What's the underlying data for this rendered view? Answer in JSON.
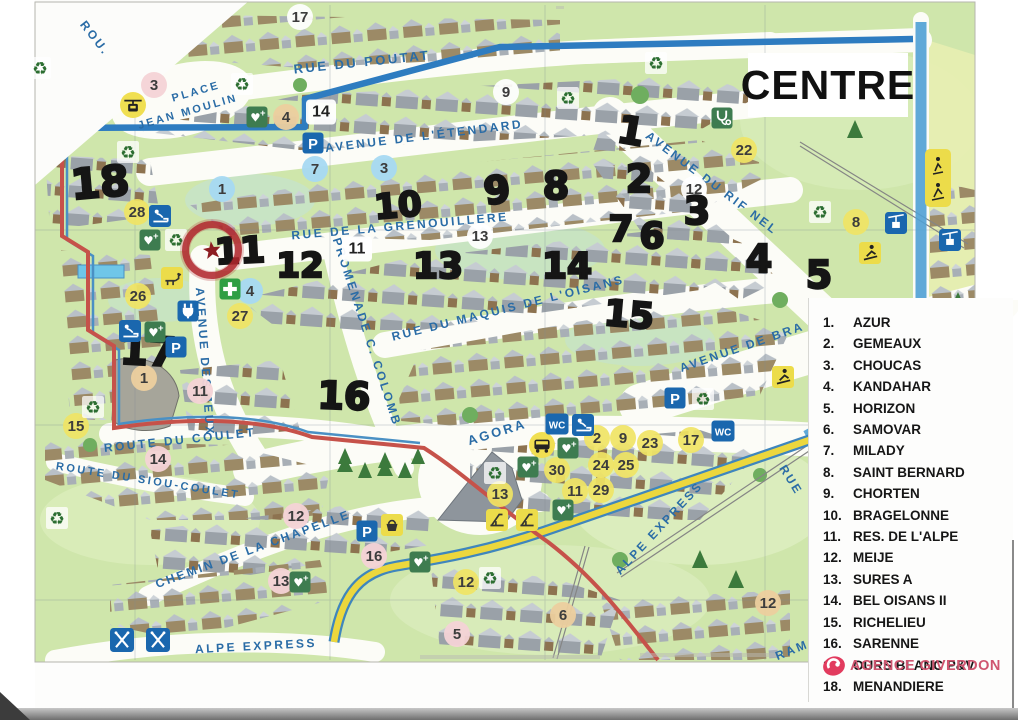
{
  "title": {
    "text": "CENTRE"
  },
  "agency": {
    "name": "AGENCE GIVERDON"
  },
  "colors": {
    "accent_blue": "#1a67ae",
    "route_blue": "#2e7cc0",
    "route_red": "#c6524a",
    "route_yellow": "#ecd73d",
    "street_label": "#2a6ca6",
    "legend_text": "#161616",
    "agency_pink": "#cf5670",
    "badge_yellow": "#f0e464",
    "badge_pink": "#f4d3d6",
    "badge_blue": "#a6d9f2",
    "badge_tan": "#eccf9e",
    "map_green": "#cfe6ab"
  },
  "legend": {
    "items": [
      {
        "num": "1.",
        "label": "AZUR"
      },
      {
        "num": "2.",
        "label": "GEMEAUX"
      },
      {
        "num": "3.",
        "label": "CHOUCAS"
      },
      {
        "num": "4.",
        "label": "KANDAHAR"
      },
      {
        "num": "5.",
        "label": "HORIZON"
      },
      {
        "num": "6.",
        "label": "SAMOVAR"
      },
      {
        "num": "7.",
        "label": "MILADY"
      },
      {
        "num": "8.",
        "label": "SAINT BERNARD"
      },
      {
        "num": "9.",
        "label": "CHORTEN"
      },
      {
        "num": "10.",
        "label": "BRAGELONNE"
      },
      {
        "num": "11.",
        "label": "RES. DE L'ALPE"
      },
      {
        "num": "12.",
        "label": "MEIJE"
      },
      {
        "num": "13.",
        "label": "SURES A"
      },
      {
        "num": "14.",
        "label": "BEL OISANS II"
      },
      {
        "num": "15.",
        "label": "RICHELIEU"
      },
      {
        "num": "16.",
        "label": "SARENNE"
      },
      {
        "num": "17.",
        "label": "OURS BLANC P&V"
      },
      {
        "num": "18.",
        "label": "MENANDIERE"
      }
    ]
  },
  "streets": [
    {
      "name": "ROU.",
      "x": 95,
      "y": 38,
      "rot": 52,
      "size": 12
    },
    {
      "name": "RUE DU POUTAT",
      "x": 362,
      "y": 62,
      "rot": -6,
      "size": 13
    },
    {
      "name": "PLACE",
      "x": 196,
      "y": 92,
      "rot": -16,
      "size": 11
    },
    {
      "name": "JEAN MOULIN",
      "x": 188,
      "y": 112,
      "rot": -16,
      "size": 11
    },
    {
      "name": "AVENUE DE L'ÉTENDARD",
      "x": 424,
      "y": 136,
      "rot": -7,
      "size": 12
    },
    {
      "name": "RUE DE LA GRENOUILLERE",
      "x": 400,
      "y": 226,
      "rot": -5,
      "size": 12
    },
    {
      "name": "AVENUE DU RIF NEL",
      "x": 712,
      "y": 183,
      "rot": 37,
      "size": 12
    },
    {
      "name": "RUE DU MAQUIS DE L'OISANS",
      "x": 508,
      "y": 308,
      "rot": -14,
      "size": 12
    },
    {
      "name": "AVENUE DE BRA",
      "x": 742,
      "y": 347,
      "rot": -19,
      "size": 12
    },
    {
      "name": "AVENUE DES JEUX",
      "x": 205,
      "y": 362,
      "rot": 86,
      "size": 12
    },
    {
      "name": "PROMENADE C. COLOMB",
      "x": 367,
      "y": 332,
      "rot": 72,
      "size": 12
    },
    {
      "name": "AGORA",
      "x": 497,
      "y": 432,
      "rot": -17,
      "size": 13
    },
    {
      "name": "ROUTE DU COULET",
      "x": 180,
      "y": 440,
      "rot": -6,
      "size": 12
    },
    {
      "name": "ROUTE DU SIOU-COULET",
      "x": 148,
      "y": 481,
      "rot": 9,
      "size": 11
    },
    {
      "name": "CHEMIN DE LA CHAPELLE",
      "x": 253,
      "y": 549,
      "rot": -20,
      "size": 12
    },
    {
      "name": "ALPE EXPRESS",
      "x": 256,
      "y": 646,
      "rot": -3,
      "size": 12
    },
    {
      "name": "ALPE EXPRESS",
      "x": 659,
      "y": 528,
      "rot": -47,
      "size": 12
    },
    {
      "name": "RUE",
      "x": 791,
      "y": 480,
      "rot": 58,
      "size": 12
    },
    {
      "name": "RAM",
      "x": 792,
      "y": 650,
      "rot": -22,
      "size": 12
    }
  ],
  "markers": [
    {
      "n": "18",
      "x": 100,
      "y": 183,
      "rot": -5,
      "size": 42
    },
    {
      "n": "17",
      "x": 148,
      "y": 352,
      "rot": 3,
      "size": 40
    },
    {
      "n": "11",
      "x": 240,
      "y": 252,
      "rot": -3,
      "size": 36
    },
    {
      "n": "12",
      "x": 300,
      "y": 266,
      "rot": 0,
      "size": 34
    },
    {
      "n": "16",
      "x": 344,
      "y": 396,
      "rot": 2,
      "size": 38
    },
    {
      "n": "10",
      "x": 398,
      "y": 206,
      "rot": -5,
      "size": 34
    },
    {
      "n": "13",
      "x": 438,
      "y": 267,
      "rot": 0,
      "size": 36
    },
    {
      "n": "9",
      "x": 497,
      "y": 190,
      "rot": -8,
      "size": 38
    },
    {
      "n": "8",
      "x": 556,
      "y": 186,
      "rot": 0,
      "size": 38
    },
    {
      "n": "14",
      "x": 567,
      "y": 267,
      "rot": 0,
      "size": 36
    },
    {
      "n": "15",
      "x": 629,
      "y": 316,
      "rot": 5,
      "size": 36
    },
    {
      "n": "7",
      "x": 621,
      "y": 230,
      "rot": 0,
      "size": 36
    },
    {
      "n": "6",
      "x": 652,
      "y": 237,
      "rot": 0,
      "size": 36
    },
    {
      "n": "1",
      "x": 631,
      "y": 131,
      "rot": 10,
      "size": 38
    },
    {
      "n": "2",
      "x": 639,
      "y": 179,
      "rot": 0,
      "size": 38
    },
    {
      "n": "3",
      "x": 697,
      "y": 211,
      "rot": 0,
      "size": 38
    },
    {
      "n": "4",
      "x": 759,
      "y": 259,
      "rot": 0,
      "size": 38
    },
    {
      "n": "5",
      "x": 819,
      "y": 275,
      "rot": 0,
      "size": 38
    }
  ],
  "badges": [
    {
      "n": "17",
      "color": "white",
      "x": 300,
      "y": 17
    },
    {
      "n": "3",
      "color": "pink",
      "x": 154,
      "y": 85
    },
    {
      "n": "4",
      "color": "tan",
      "x": 286,
      "y": 117
    },
    {
      "n": "14",
      "color": "box",
      "x": 321,
      "y": 112
    },
    {
      "n": "9",
      "color": "white",
      "x": 506,
      "y": 92
    },
    {
      "n": "22",
      "color": "yellow",
      "x": 744,
      "y": 150
    },
    {
      "n": "1",
      "color": "blue",
      "x": 222,
      "y": 189
    },
    {
      "n": "7",
      "color": "blue",
      "x": 315,
      "y": 169
    },
    {
      "n": "3",
      "color": "blue",
      "x": 384,
      "y": 168
    },
    {
      "n": "12",
      "color": "white",
      "x": 694,
      "y": 189
    },
    {
      "n": "13",
      "color": "white",
      "x": 480,
      "y": 236
    },
    {
      "n": "11",
      "color": "box",
      "x": 357,
      "y": 249
    },
    {
      "n": "8",
      "color": "yellow",
      "x": 856,
      "y": 222
    },
    {
      "n": "28",
      "color": "yellow",
      "x": 137,
      "y": 212
    },
    {
      "n": "26",
      "color": "yellow",
      "x": 138,
      "y": 296
    },
    {
      "n": "4",
      "color": "blue",
      "x": 250,
      "y": 291
    },
    {
      "n": "27",
      "color": "yellow",
      "x": 240,
      "y": 316
    },
    {
      "n": "1",
      "color": "tan",
      "x": 144,
      "y": 378
    },
    {
      "n": "11",
      "color": "pink",
      "x": 200,
      "y": 391
    },
    {
      "n": "15",
      "color": "yellow",
      "x": 76,
      "y": 426
    },
    {
      "n": "14",
      "color": "pink",
      "x": 158,
      "y": 459
    },
    {
      "n": "12",
      "color": "pink",
      "x": 296,
      "y": 516
    },
    {
      "n": "16",
      "color": "pink",
      "x": 374,
      "y": 556
    },
    {
      "n": "13",
      "color": "pink",
      "x": 281,
      "y": 581
    },
    {
      "n": "12",
      "color": "yellow",
      "x": 466,
      "y": 582
    },
    {
      "n": "5",
      "color": "pink",
      "x": 457,
      "y": 634
    },
    {
      "n": "6",
      "color": "tan",
      "x": 563,
      "y": 615
    },
    {
      "n": "12",
      "color": "tan",
      "x": 768,
      "y": 603
    },
    {
      "n": "2",
      "color": "yellow",
      "x": 597,
      "y": 438
    },
    {
      "n": "9",
      "color": "yellow",
      "x": 623,
      "y": 438
    },
    {
      "n": "23",
      "color": "yellow",
      "x": 650,
      "y": 443
    },
    {
      "n": "17",
      "color": "yellow",
      "x": 691,
      "y": 440
    },
    {
      "n": "24",
      "color": "yellow",
      "x": 601,
      "y": 465
    },
    {
      "n": "25",
      "color": "yellow",
      "x": 626,
      "y": 465
    },
    {
      "n": "30",
      "color": "yellow",
      "x": 557,
      "y": 470
    },
    {
      "n": "11",
      "color": "yellow",
      "x": 575,
      "y": 491
    },
    {
      "n": "29",
      "color": "yellow",
      "x": 601,
      "y": 490
    },
    {
      "n": "13",
      "color": "yellow",
      "x": 500,
      "y": 494
    }
  ],
  "icons": [
    {
      "type": "gondola-circle",
      "x": 133,
      "y": 105
    },
    {
      "type": "bus-circle",
      "x": 542,
      "y": 445
    },
    {
      "type": "parking",
      "x": 313,
      "y": 143
    },
    {
      "type": "parking",
      "x": 176,
      "y": 347
    },
    {
      "type": "parking",
      "x": 675,
      "y": 398
    },
    {
      "type": "parking",
      "x": 367,
      "y": 531
    },
    {
      "type": "wc",
      "x": 557,
      "y": 424
    },
    {
      "type": "wc",
      "x": 723,
      "y": 431
    },
    {
      "type": "baby",
      "x": 160,
      "y": 216
    },
    {
      "type": "baby",
      "x": 130,
      "y": 331
    },
    {
      "type": "baby",
      "x": 583,
      "y": 425
    },
    {
      "type": "defib",
      "x": 257,
      "y": 117
    },
    {
      "type": "defib",
      "x": 150,
      "y": 240
    },
    {
      "type": "defib",
      "x": 155,
      "y": 332
    },
    {
      "type": "defib",
      "x": 528,
      "y": 467
    },
    {
      "type": "defib",
      "x": 568,
      "y": 448
    },
    {
      "type": "defib",
      "x": 563,
      "y": 510
    },
    {
      "type": "defib",
      "x": 420,
      "y": 562
    },
    {
      "type": "defib",
      "x": 300,
      "y": 582
    },
    {
      "type": "recycle",
      "x": 128,
      "y": 152
    },
    {
      "type": "recycle",
      "x": 176,
      "y": 240
    },
    {
      "type": "recycle",
      "x": 242,
      "y": 84
    },
    {
      "type": "recycle",
      "x": 568,
      "y": 98
    },
    {
      "type": "recycle",
      "x": 656,
      "y": 63
    },
    {
      "type": "recycle",
      "x": 820,
      "y": 212
    },
    {
      "type": "recycle",
      "x": 703,
      "y": 399
    },
    {
      "type": "recycle",
      "x": 495,
      "y": 473
    },
    {
      "type": "recycle",
      "x": 490,
      "y": 578
    },
    {
      "type": "recycle",
      "x": 93,
      "y": 407
    },
    {
      "type": "recycle",
      "x": 57,
      "y": 518
    },
    {
      "type": "recycle",
      "x": 40,
      "y": 68
    },
    {
      "type": "cross",
      "x": 230,
      "y": 289
    },
    {
      "type": "plug",
      "x": 188,
      "y": 311
    },
    {
      "type": "steth",
      "x": 722,
      "y": 118
    },
    {
      "type": "chairlift",
      "x": 896,
      "y": 223
    },
    {
      "type": "chairlift",
      "x": 950,
      "y": 240
    },
    {
      "type": "skier",
      "x": 870,
      "y": 253
    },
    {
      "type": "skier",
      "x": 783,
      "y": 377
    },
    {
      "type": "dog",
      "x": 172,
      "y": 278
    },
    {
      "type": "basket",
      "x": 392,
      "y": 525
    },
    {
      "type": "skicross",
      "x": 122,
      "y": 640
    },
    {
      "type": "skicross",
      "x": 158,
      "y": 640
    },
    {
      "type": "play",
      "x": 497,
      "y": 520
    },
    {
      "type": "play",
      "x": 527,
      "y": 520
    },
    {
      "type": "infopanel",
      "x": 938,
      "y": 178
    }
  ]
}
